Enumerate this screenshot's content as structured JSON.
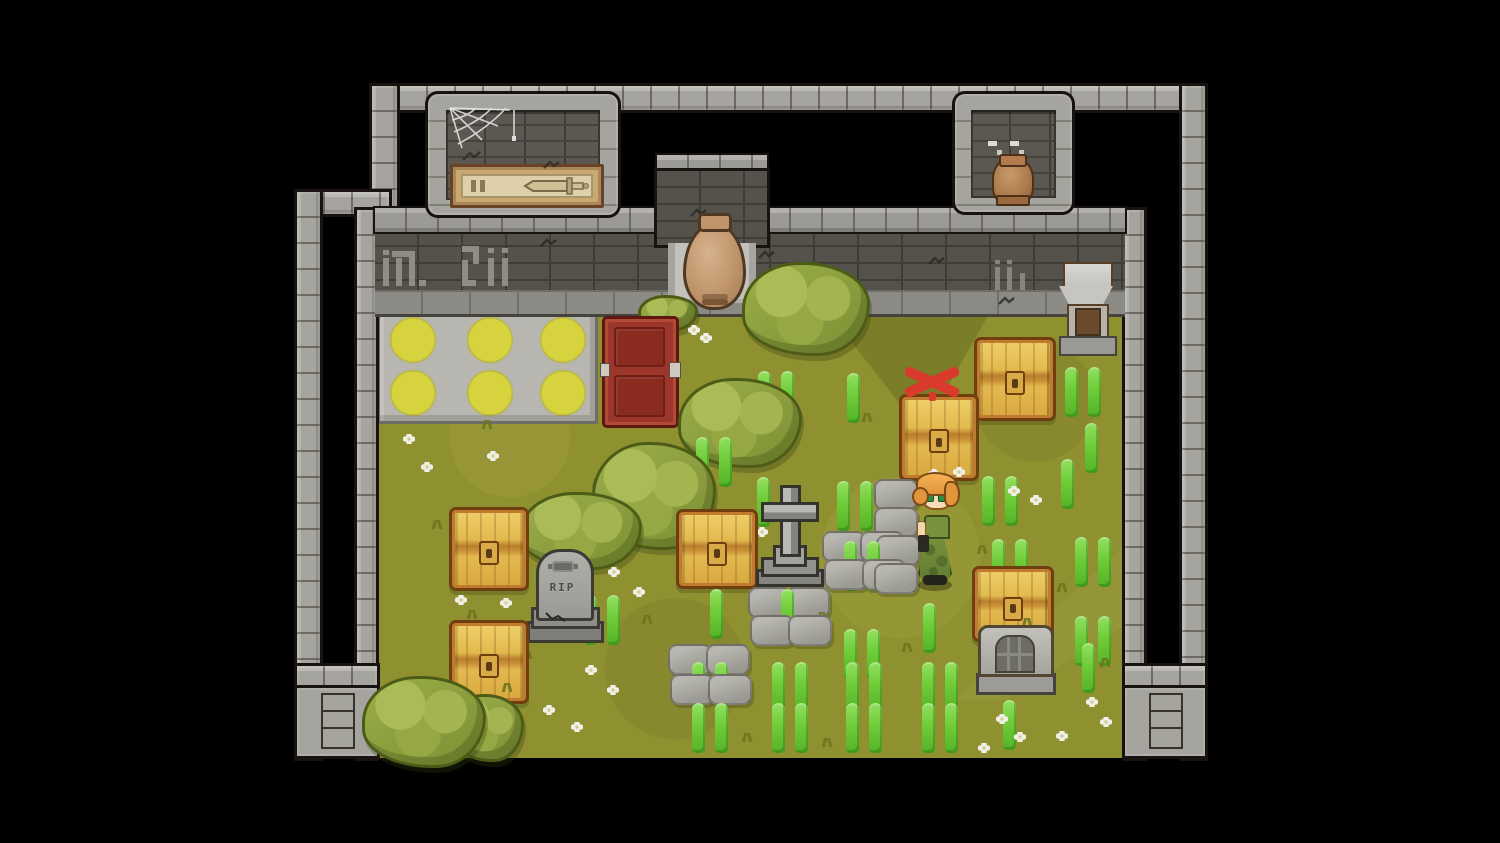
{
  "scene": {
    "rip_text": "RIP"
  },
  "palette": {
    "background": "#000000",
    "grass": "#8f9030",
    "wall_light": "#a5a49e",
    "wall_dark": "#55524c",
    "outline": "#181310",
    "chest_gold": "#e2ba4e",
    "chest_frame": "#b06f2a",
    "red_chest": "#9c352a",
    "sprout_green": "#6fcc39",
    "x_marker_red": "#d93a2c",
    "amphora_clay": "#c0956c",
    "circle_yellow": "#d6d33e",
    "hair_orange": "#e2953a",
    "dress_green": "#77923c"
  },
  "sprites": [
    {
      "t": "chest",
      "n": "treasure-chest",
      "i": true,
      "x": 449,
      "y": 507,
      "w": 74,
      "h": 78
    },
    {
      "t": "chest",
      "n": "treasure-chest",
      "i": true,
      "x": 449,
      "y": 620,
      "w": 74,
      "h": 78
    },
    {
      "t": "chest",
      "n": "treasure-chest",
      "i": true,
      "x": 676,
      "y": 509,
      "w": 76,
      "h": 74
    },
    {
      "t": "chest",
      "n": "treasure-chest-marked",
      "i": true,
      "x": 899,
      "y": 394,
      "w": 74,
      "h": 81
    },
    {
      "t": "chest",
      "n": "treasure-chest",
      "i": true,
      "x": 974,
      "y": 337,
      "w": 76,
      "h": 78
    },
    {
      "t": "chest",
      "n": "treasure-chest",
      "i": true,
      "x": 972,
      "y": 566,
      "w": 76,
      "h": 70,
      "z": 636
    },
    {
      "t": "bush",
      "n": "bush",
      "i": false,
      "x": 742,
      "y": 262,
      "w": 122,
      "h": 88
    },
    {
      "t": "bush",
      "n": "bush",
      "i": false,
      "x": 638,
      "y": 295,
      "w": 54,
      "h": 30
    },
    {
      "t": "bush",
      "n": "bush",
      "i": false,
      "x": 678,
      "y": 378,
      "w": 118,
      "h": 84
    },
    {
      "t": "bush",
      "n": "bush",
      "i": false,
      "x": 592,
      "y": 442,
      "w": 118,
      "h": 102
    },
    {
      "t": "bush",
      "n": "bush",
      "i": false,
      "x": 520,
      "y": 492,
      "w": 116,
      "h": 72
    },
    {
      "t": "bush",
      "n": "bush",
      "i": false,
      "x": 362,
      "y": 676,
      "w": 118,
      "h": 86
    },
    {
      "t": "bush",
      "n": "bush",
      "i": false,
      "x": 450,
      "y": 694,
      "w": 68,
      "h": 62
    },
    {
      "t": "slab",
      "n": "stone-slab",
      "i": false,
      "x": 822,
      "y": 531
    },
    {
      "t": "slab",
      "n": "stone-slab",
      "i": false,
      "x": 860,
      "y": 531
    },
    {
      "t": "slab",
      "n": "stone-slab",
      "i": false,
      "x": 824,
      "y": 559
    },
    {
      "t": "slab",
      "n": "stone-slab",
      "i": false,
      "x": 862,
      "y": 559
    },
    {
      "t": "slab",
      "n": "stone-slab",
      "i": false,
      "x": 748,
      "y": 587
    },
    {
      "t": "slab",
      "n": "stone-slab",
      "i": false,
      "x": 786,
      "y": 587
    },
    {
      "t": "slab",
      "n": "stone-slab",
      "i": false,
      "x": 750,
      "y": 615
    },
    {
      "t": "slab",
      "n": "stone-slab",
      "i": false,
      "x": 788,
      "y": 615
    },
    {
      "t": "slab",
      "n": "stone-slab",
      "i": false,
      "x": 668,
      "y": 644
    },
    {
      "t": "slab",
      "n": "stone-slab",
      "i": false,
      "x": 706,
      "y": 644
    },
    {
      "t": "slab",
      "n": "stone-slab",
      "i": false,
      "x": 670,
      "y": 674
    },
    {
      "t": "slab",
      "n": "stone-slab",
      "i": false,
      "x": 708,
      "y": 674
    },
    {
      "t": "slab",
      "n": "stone-slab",
      "i": false,
      "x": 874,
      "y": 479
    },
    {
      "t": "slab",
      "n": "stone-slab",
      "i": false,
      "x": 874,
      "y": 507
    },
    {
      "t": "slab",
      "n": "stone-slab",
      "i": false,
      "x": 876,
      "y": 535
    },
    {
      "t": "slab",
      "n": "stone-slab",
      "i": false,
      "x": 874,
      "y": 563
    },
    {
      "t": "sprout2",
      "n": "sprout-pair",
      "i": false,
      "x": 757,
      "y": 371
    },
    {
      "t": "sprout2",
      "n": "sprout-pair",
      "i": false,
      "x": 1064,
      "y": 367
    },
    {
      "t": "sprout2",
      "n": "sprout-pair",
      "i": false,
      "x": 695,
      "y": 437
    },
    {
      "t": "sprout2",
      "n": "sprout-pair",
      "i": false,
      "x": 836,
      "y": 481
    },
    {
      "t": "sprout2",
      "n": "sprout-pair",
      "i": false,
      "x": 981,
      "y": 476
    },
    {
      "t": "sprout2",
      "n": "sprout-pair",
      "i": false,
      "x": 991,
      "y": 539
    },
    {
      "t": "sprout2",
      "n": "sprout-pair",
      "i": false,
      "x": 843,
      "y": 541
    },
    {
      "t": "sprout2",
      "n": "sprout-pair",
      "i": false,
      "x": 1074,
      "y": 537
    },
    {
      "t": "sprout2",
      "n": "sprout-pair",
      "i": false,
      "x": 583,
      "y": 595
    },
    {
      "t": "sprout2",
      "n": "sprout-pair",
      "i": false,
      "x": 843,
      "y": 629
    },
    {
      "t": "sprout2",
      "n": "sprout-pair",
      "i": false,
      "x": 691,
      "y": 662
    },
    {
      "t": "sprout2",
      "n": "sprout-pair",
      "i": false,
      "x": 771,
      "y": 662
    },
    {
      "t": "sprout2",
      "n": "sprout-pair",
      "i": false,
      "x": 845,
      "y": 662
    },
    {
      "t": "sprout2",
      "n": "sprout-pair",
      "i": false,
      "x": 921,
      "y": 662
    },
    {
      "t": "sprout2",
      "n": "sprout-pair",
      "i": false,
      "x": 691,
      "y": 703
    },
    {
      "t": "sprout2",
      "n": "sprout-pair",
      "i": false,
      "x": 771,
      "y": 703
    },
    {
      "t": "sprout2",
      "n": "sprout-pair",
      "i": false,
      "x": 845,
      "y": 703
    },
    {
      "t": "sprout2",
      "n": "sprout-pair",
      "i": false,
      "x": 921,
      "y": 703
    },
    {
      "t": "sprout2",
      "n": "sprout-pair",
      "i": false,
      "x": 1074,
      "y": 616
    },
    {
      "t": "sprout1",
      "n": "sprout",
      "i": false,
      "x": 847,
      "y": 373
    },
    {
      "t": "sprout1",
      "n": "sprout",
      "i": false,
      "x": 1085,
      "y": 423
    },
    {
      "t": "sprout1",
      "n": "sprout",
      "i": false,
      "x": 1061,
      "y": 459
    },
    {
      "t": "sprout1",
      "n": "sprout",
      "i": false,
      "x": 710,
      "y": 589
    },
    {
      "t": "sprout1",
      "n": "sprout",
      "i": false,
      "x": 781,
      "y": 589
    },
    {
      "t": "sprout1",
      "n": "sprout",
      "i": false,
      "x": 923,
      "y": 603
    },
    {
      "t": "sprout1",
      "n": "sprout",
      "i": false,
      "x": 1003,
      "y": 700
    },
    {
      "t": "sprout1",
      "n": "sprout",
      "i": false,
      "x": 757,
      "y": 477
    },
    {
      "t": "sprout1",
      "n": "sprout",
      "i": false,
      "x": 1082,
      "y": 643
    },
    {
      "t": "flower",
      "n": "flower",
      "i": false,
      "x": 403,
      "y": 434
    },
    {
      "t": "flower",
      "n": "flower",
      "i": false,
      "x": 421,
      "y": 462
    },
    {
      "t": "flower",
      "n": "flower",
      "i": false,
      "x": 487,
      "y": 451
    },
    {
      "t": "flower",
      "n": "flower",
      "i": false,
      "x": 556,
      "y": 509
    },
    {
      "t": "flower",
      "n": "flower",
      "i": false,
      "x": 583,
      "y": 521
    },
    {
      "t": "flower",
      "n": "flower",
      "i": false,
      "x": 608,
      "y": 567
    },
    {
      "t": "flower",
      "n": "flower",
      "i": false,
      "x": 633,
      "y": 587
    },
    {
      "t": "flower",
      "n": "flower",
      "i": false,
      "x": 928,
      "y": 469
    },
    {
      "t": "flower",
      "n": "flower",
      "i": false,
      "x": 953,
      "y": 467
    },
    {
      "t": "flower",
      "n": "flower",
      "i": false,
      "x": 1008,
      "y": 486
    },
    {
      "t": "flower",
      "n": "flower",
      "i": false,
      "x": 1030,
      "y": 495
    },
    {
      "t": "flower",
      "n": "flower",
      "i": false,
      "x": 585,
      "y": 665
    },
    {
      "t": "flower",
      "n": "flower",
      "i": false,
      "x": 607,
      "y": 685
    },
    {
      "t": "flower",
      "n": "flower",
      "i": false,
      "x": 543,
      "y": 705
    },
    {
      "t": "flower",
      "n": "flower",
      "i": false,
      "x": 571,
      "y": 722
    },
    {
      "t": "flower",
      "n": "flower",
      "i": false,
      "x": 1086,
      "y": 697
    },
    {
      "t": "flower",
      "n": "flower",
      "i": false,
      "x": 1100,
      "y": 717
    },
    {
      "t": "flower",
      "n": "flower",
      "i": false,
      "x": 1056,
      "y": 731
    },
    {
      "t": "flower",
      "n": "flower",
      "i": false,
      "x": 996,
      "y": 714
    },
    {
      "t": "flower",
      "n": "flower",
      "i": false,
      "x": 1014,
      "y": 732
    },
    {
      "t": "flower",
      "n": "flower",
      "i": false,
      "x": 978,
      "y": 743
    },
    {
      "t": "flower",
      "n": "flower",
      "i": false,
      "x": 688,
      "y": 325
    },
    {
      "t": "flower",
      "n": "flower",
      "i": false,
      "x": 700,
      "y": 333
    },
    {
      "t": "flower",
      "n": "flower",
      "i": false,
      "x": 455,
      "y": 595
    },
    {
      "t": "flower",
      "n": "flower",
      "i": false,
      "x": 500,
      "y": 598
    },
    {
      "t": "flower",
      "n": "flower",
      "i": false,
      "x": 756,
      "y": 527
    },
    {
      "t": "tuft",
      "n": "grass-tuft",
      "i": false,
      "x": 430,
      "y": 520
    },
    {
      "t": "tuft",
      "n": "grass-tuft",
      "i": false,
      "x": 465,
      "y": 610
    },
    {
      "t": "tuft",
      "n": "grass-tuft",
      "i": false,
      "x": 520,
      "y": 650
    },
    {
      "t": "tuft",
      "n": "grass-tuft",
      "i": false,
      "x": 640,
      "y": 615
    },
    {
      "t": "tuft",
      "n": "grass-tuft",
      "i": false,
      "x": 700,
      "y": 515
    },
    {
      "t": "tuft",
      "n": "grass-tuft",
      "i": false,
      "x": 815,
      "y": 612
    },
    {
      "t": "tuft",
      "n": "grass-tuft",
      "i": false,
      "x": 900,
      "y": 643
    },
    {
      "t": "tuft",
      "n": "grass-tuft",
      "i": false,
      "x": 975,
      "y": 545
    },
    {
      "t": "tuft",
      "n": "grass-tuft",
      "i": false,
      "x": 1055,
      "y": 583
    },
    {
      "t": "tuft",
      "n": "grass-tuft",
      "i": false,
      "x": 500,
      "y": 683
    },
    {
      "t": "tuft",
      "n": "grass-tuft",
      "i": false,
      "x": 590,
      "y": 478
    },
    {
      "t": "tuft",
      "n": "grass-tuft",
      "i": false,
      "x": 860,
      "y": 413
    },
    {
      "t": "tuft",
      "n": "grass-tuft",
      "i": false,
      "x": 950,
      "y": 428
    },
    {
      "t": "tuft",
      "n": "grass-tuft",
      "i": false,
      "x": 1020,
      "y": 618
    },
    {
      "t": "tuft",
      "n": "grass-tuft",
      "i": false,
      "x": 740,
      "y": 733
    },
    {
      "t": "tuft",
      "n": "grass-tuft",
      "i": false,
      "x": 820,
      "y": 738
    },
    {
      "t": "tuft",
      "n": "grass-tuft",
      "i": false,
      "x": 480,
      "y": 420
    },
    {
      "t": "tuft",
      "n": "grass-tuft",
      "i": false,
      "x": 1098,
      "y": 658
    }
  ]
}
